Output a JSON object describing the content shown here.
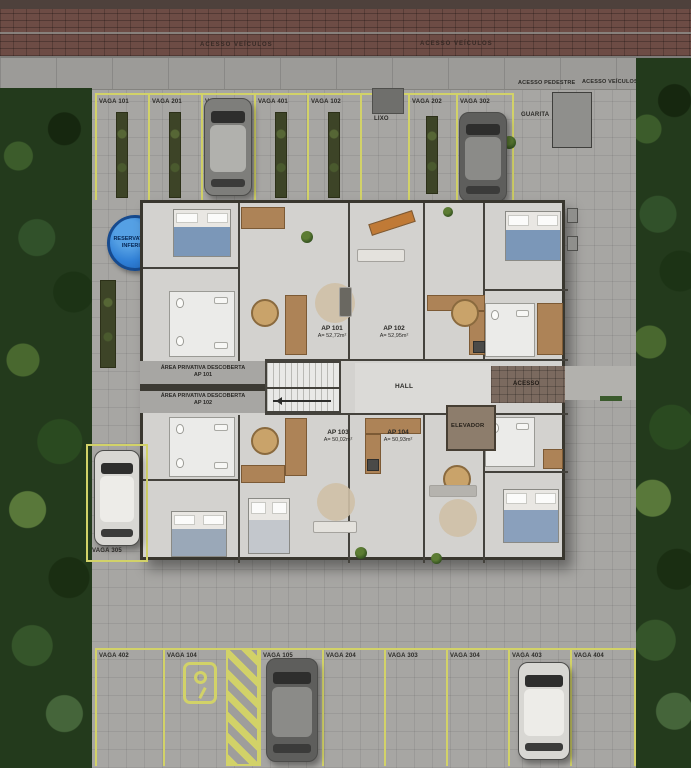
{
  "street": {
    "marking_left": "ACESSO VEÍCULOS",
    "marking_right": "ACESSO VEÍCULOS"
  },
  "sidewalk": {
    "pedestrian": "ACESSO PEDESTRE",
    "vehicles": "ACESSO VEÍCULOS"
  },
  "top_row": {
    "spots": [
      "VAGA 101",
      "VAGA 201",
      "VAGA 301",
      "VAGA 401",
      "VAGA 102",
      "VAGA 202",
      "VAGA 302"
    ],
    "trash": "LIXO",
    "guardhouse": "GUARITA"
  },
  "reservoir": {
    "line1": "RESERVATÓRIO",
    "line2": "INFERIOR"
  },
  "building": {
    "apartments": [
      {
        "name": "AP 101",
        "area": "A= 52,72m²"
      },
      {
        "name": "AP 102",
        "area": "A= 52,95m²"
      },
      {
        "name": "AP 103",
        "area": "A= 50,02m²"
      },
      {
        "name": "AP 104",
        "area": "A= 50,93m²"
      }
    ],
    "hall": "HALL",
    "elevator": "ELEVADOR",
    "access": "ACESSO",
    "private_areas": [
      {
        "line1": "ÁREA PRIVATIVA DESCOBERTA",
        "line2": "AP 101"
      },
      {
        "line1": "ÁREA PRIVATIVA DESCOBERTA",
        "line2": "AP 102"
      }
    ]
  },
  "side_parking": {
    "label": "VAGA 305"
  },
  "bottom_row": {
    "spots": [
      "VAGA 402",
      "VAGA 104",
      "VAGA 105",
      "VAGA 204",
      "VAGA 303",
      "VAGA 304",
      "VAGA 403",
      "VAGA 404"
    ]
  },
  "icons": {
    "spot_symbol": "circle-hook-marker"
  },
  "colors": {
    "parking_line": "#d2d268",
    "reservoir_blue": "#2f7fd6",
    "vegetation": "#233a1c",
    "brick_street": "#6d4c45",
    "pavement": "#a7a6a3"
  }
}
